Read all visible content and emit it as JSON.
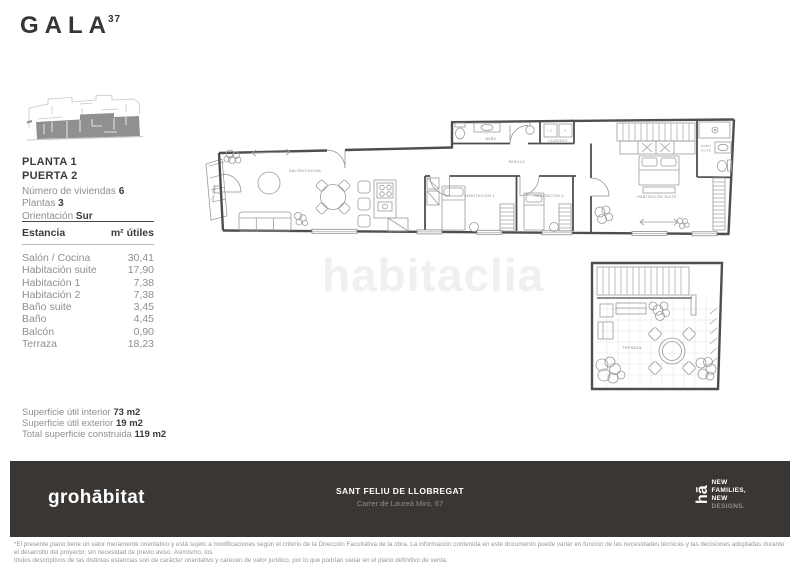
{
  "brand": {
    "name": "GALA",
    "sup": "37"
  },
  "unit": {
    "planta": "PLANTA 1",
    "puerta": "PUERTA 2",
    "features": [
      {
        "label": "Número de viviendas",
        "value": "6"
      },
      {
        "label": "Plantas",
        "value": "3"
      },
      {
        "label": "Orientación",
        "value": "Sur"
      }
    ]
  },
  "rooms_table": {
    "col_room": "Estancia",
    "col_area": "m² útiles",
    "rows": [
      {
        "name": "Salón / Cocina",
        "area": "30,41"
      },
      {
        "name": "Habitación suite",
        "area": "17,90"
      },
      {
        "name": "Habitación 1",
        "area": "7,38"
      },
      {
        "name": "Habitación 2",
        "area": "7,38"
      },
      {
        "name": "Baño suite",
        "area": "3,45"
      },
      {
        "name": "Baño",
        "area": "4,45"
      },
      {
        "name": "Balcón",
        "area": "0,90"
      },
      {
        "name": "Terraza",
        "area": "18,23"
      }
    ]
  },
  "summary": {
    "items": [
      {
        "label": "Superficie útil interior",
        "value": "73 m2"
      },
      {
        "label": "Superficie útil exterior",
        "value": "19 m2"
      },
      {
        "label": "Total superficie construida",
        "value": "119 m2"
      }
    ]
  },
  "floorplan": {
    "labels": {
      "balcon": "BALCÓN",
      "salon": "SALÓN/COCINA",
      "bano": "BAÑO",
      "lavadero": "LAVADERO",
      "ls": "L.S.",
      "a": "A",
      "pasillo": "PASILLO",
      "hab1": "HABITACIÓN 1",
      "hab2": "HABITACIÓN 2",
      "suite": "HABITACIÓN SUITE",
      "bano_suite_1": "BAÑO",
      "bano_suite_2": "SUITE",
      "terraza": "TERRAZA"
    }
  },
  "watermark": "habitaclia",
  "footer": {
    "brand": "grohābitat",
    "city": "SANT FELIU DE LLOBREGAT",
    "address": "Carrer de Laureà Miró, 67",
    "logo": "hā",
    "tagline": [
      "NEW",
      "FAMILIES,",
      "NEW",
      "DESIGNS."
    ],
    "bg_color": "#393634"
  },
  "disclaimer": {
    "line1": "*El presente plano tiene un valor meramente orientativo y está sujeto a modificaciones según el criterio de la Dirección Facultativa de la obra.  La información contenida en este documento puede variar en función de las necesidades técnicas y las decisiones adoptadas durante el desarrollo  del proyecto, sin necesidad de previo aviso.  Asimismo, los",
    "line2": "títulos descriptivos de las distintas estancias son de carácter orientativo y carecen de valor jurídico, por lo que podrían variar en el plano definitivo de venta."
  }
}
